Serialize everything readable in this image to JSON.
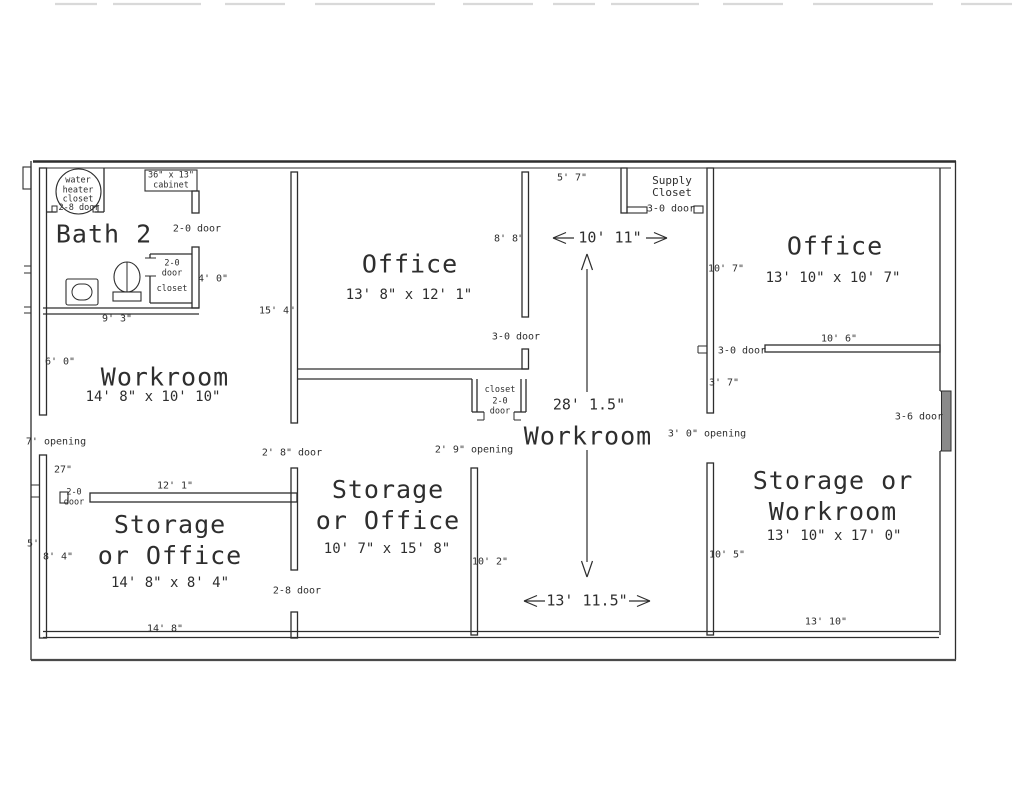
{
  "bath": {
    "title": "Bath 2",
    "water_heater": "water\nheater\ncloset",
    "cabinet": "36\" x 13\"\ncabinet",
    "door_top": "2-8 door",
    "door_right": "2-0 door",
    "closet_door": "2-0\ndoor",
    "closet_label": "closet",
    "dim_closet": "4' 0\"",
    "dim_width": "9' 3\""
  },
  "workroom_left": {
    "title": "Workroom",
    "dims": "14' 8\" x 10' 10\"",
    "dim_wall_left": "6' 0\"",
    "dim_wall_right": "15' 4\""
  },
  "storage_office_left": {
    "title": "Storage\nor Office",
    "dims": "14' 8\" x 8' 4\"",
    "opening": "7' opening",
    "dim_27": "27\"",
    "door_left": "2-0\ndoor",
    "dim_top": "12' 1\"",
    "door_top": "2' 8\" door",
    "dim_left_outer": "5'",
    "dim_left": "8' 4\"",
    "dim_bottom": "14' 8\"",
    "door_bottom": "2-8 door"
  },
  "office_top": {
    "title": "Office",
    "dims": "13' 8\" x 12' 1\"",
    "dim_right_wall": "8' 8\"",
    "door_bottom": "3-0 door",
    "closet_label": "closet",
    "closet_door": "2-0\ndoor"
  },
  "storage_office_mid": {
    "title": "Storage\nor Office",
    "dims": "10' 7\" x 15' 8\"",
    "opening": "2' 9\" opening",
    "dim_right": "10' 2\""
  },
  "workroom_center": {
    "title": "Workroom",
    "dim_top": "5' 7\"",
    "supply_closet": "Supply\nCloset",
    "supply_door": "3-0 door",
    "dim_width": "10' 11\"",
    "dim_height": "28' 1.5\"",
    "dim_bottom_width": "13' 11.5\"",
    "opening_right": "3' 0\" opening"
  },
  "office_right": {
    "title": "Office",
    "dims": "13' 10\" x 10' 7\"",
    "dim_left_wall": "10' 7\"",
    "dim_bottom": "10' 6\"",
    "door_bottom": "3-0 door",
    "dim_wall_below": "3' 7\""
  },
  "storage_workroom": {
    "title": "Storage or\nWorkroom",
    "dims": "13' 10\" x 17' 0\"",
    "dim_left": "10' 5\"",
    "dim_bottom": "13' 10\"",
    "door_right": "3-6 door"
  }
}
